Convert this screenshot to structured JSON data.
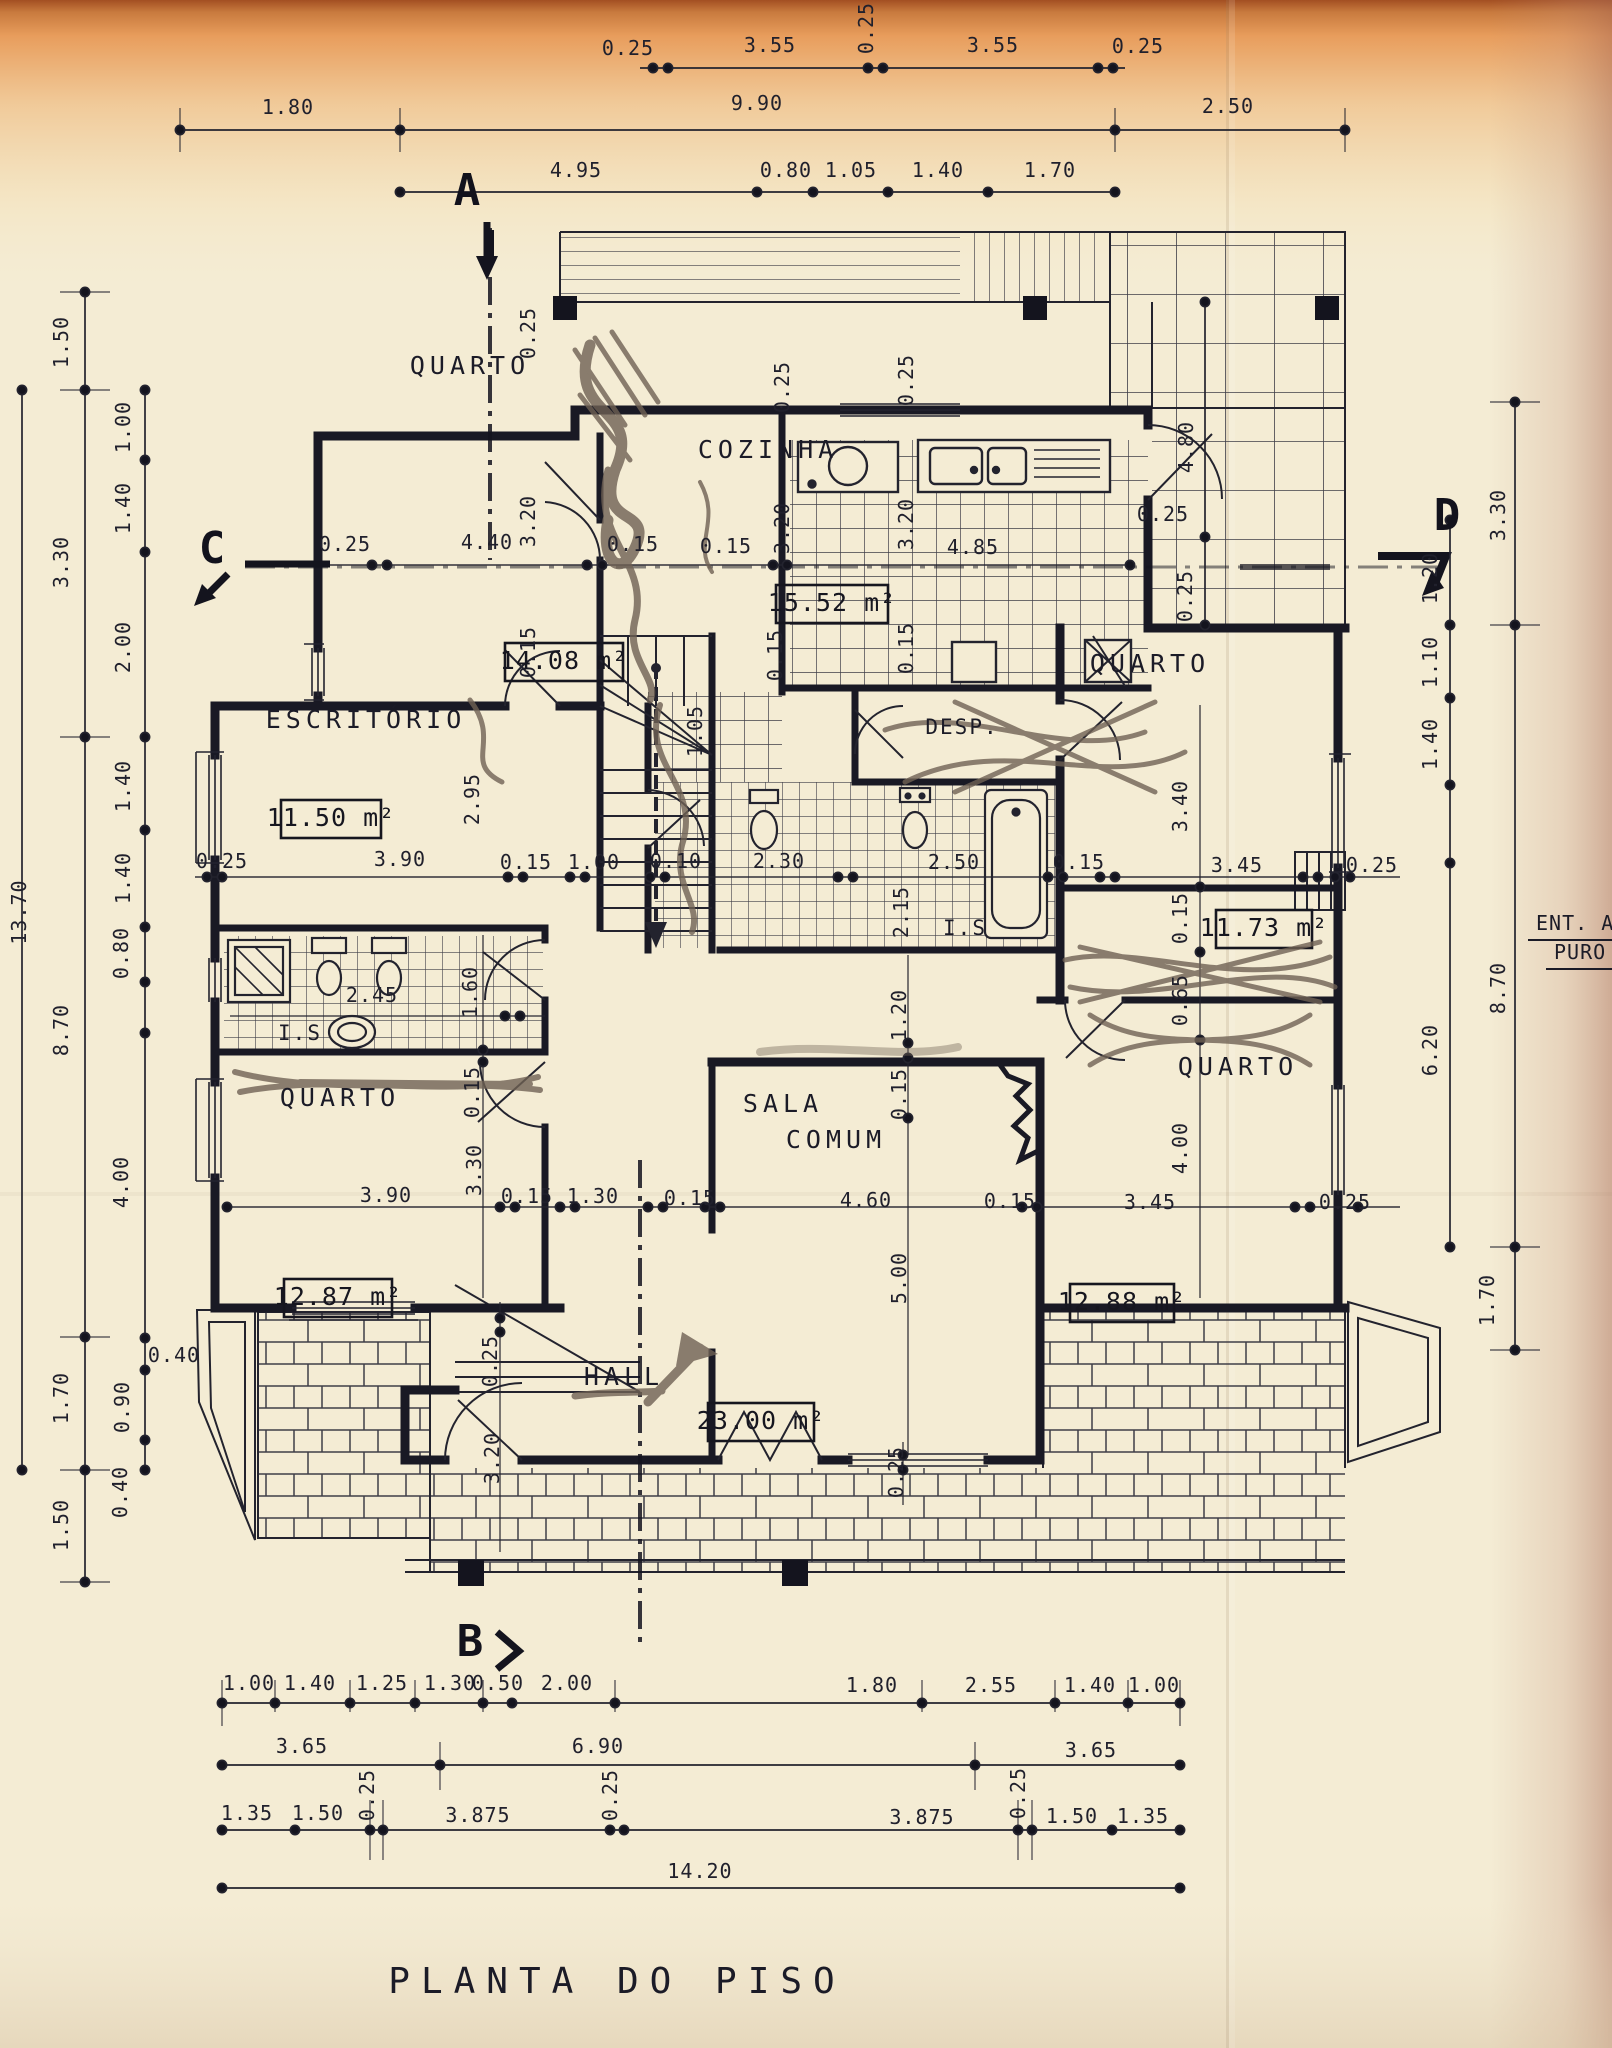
{
  "document": {
    "title": "PLANTA DO PISO",
    "type": "floor-plan-scan",
    "margin_note": [
      "ENT. A",
      "PURO"
    ],
    "overall_width_m": "14.20",
    "overall_height_m": "13.70"
  },
  "section_markers": [
    "A",
    "B",
    "C",
    "D"
  ],
  "rooms": [
    {
      "name": "QUARTO",
      "area": "14.08 m²",
      "dims": "4.40 x 3.20"
    },
    {
      "name": "COZINHA",
      "area": "15.52 m²",
      "dims": "4.85 x 3.20"
    },
    {
      "name": "ESCRITÓRIO",
      "area": "11.50 m²",
      "dims": "3.90 x 2.95"
    },
    {
      "name": "DESP.",
      "area": "",
      "dims": "1.05 high"
    },
    {
      "name": "QUARTO",
      "area": "11.73 m²",
      "dims": "3.45 x 3.40"
    },
    {
      "name": "QUARTO",
      "area": "12.87 m²",
      "dims": "3.90 x 3.30"
    },
    {
      "name": "SALA COMUM",
      "area": "23.00 m²",
      "dims": "4.60 x 5.00"
    },
    {
      "name": "QUARTO",
      "area": "12.88 m²",
      "dims": "3.45 x 4.00"
    },
    {
      "name": "HALL",
      "area": "",
      "dims": ""
    },
    {
      "name": "I.S.",
      "area": "",
      "dims": "2.45 x 1.60"
    },
    {
      "name": "I.S.",
      "area": "",
      "dims": "2.50 x 2.15"
    }
  ],
  "labels": [
    {
      "t": "0.25",
      "x": 628,
      "y": 55
    },
    {
      "t": "3.55",
      "x": 770,
      "y": 52
    },
    {
      "t": "0.25",
      "x": 873,
      "y": 28,
      "r": 1
    },
    {
      "t": "3.55",
      "x": 993,
      "y": 52
    },
    {
      "t": "0.25",
      "x": 1138,
      "y": 53
    },
    {
      "t": "1.80",
      "x": 288,
      "y": 114
    },
    {
      "t": "9.90",
      "x": 757,
      "y": 110
    },
    {
      "t": "2.50",
      "x": 1228,
      "y": 113
    },
    {
      "t": "4.95",
      "x": 576,
      "y": 177
    },
    {
      "t": "0.80",
      "x": 786,
      "y": 177
    },
    {
      "t": "1.05",
      "x": 851,
      "y": 177
    },
    {
      "t": "1.40",
      "x": 938,
      "y": 177
    },
    {
      "t": "1.70",
      "x": 1050,
      "y": 177
    },
    {
      "t": "1.50",
      "x": 68,
      "y": 342,
      "r": 1
    },
    {
      "t": "3.30",
      "x": 68,
      "y": 562,
      "r": 1
    },
    {
      "t": "8.70",
      "x": 68,
      "y": 1030,
      "r": 1
    },
    {
      "t": "1.70",
      "x": 68,
      "y": 1398,
      "r": 1
    },
    {
      "t": "1.50",
      "x": 68,
      "y": 1525,
      "r": 1
    },
    {
      "t": "13.70",
      "x": 26,
      "y": 912,
      "r": 1
    },
    {
      "t": "1.00",
      "x": 130,
      "y": 427,
      "r": 1
    },
    {
      "t": "1.40",
      "x": 130,
      "y": 508,
      "r": 1
    },
    {
      "t": "2.00",
      "x": 130,
      "y": 647,
      "r": 1
    },
    {
      "t": "1.40",
      "x": 130,
      "y": 786,
      "r": 1
    },
    {
      "t": "1.40",
      "x": 130,
      "y": 878,
      "r": 1
    },
    {
      "t": "0.80",
      "x": 128,
      "y": 953,
      "r": 1
    },
    {
      "t": "4.00",
      "x": 128,
      "y": 1182,
      "r": 1
    },
    {
      "t": "0.40",
      "x": 174,
      "y": 1362
    },
    {
      "t": "0.90",
      "x": 129,
      "y": 1407,
      "r": 1
    },
    {
      "t": "0.40",
      "x": 127,
      "y": 1492,
      "r": 1
    },
    {
      "t": "3.30",
      "x": 1505,
      "y": 515,
      "r": 1
    },
    {
      "t": "8.70",
      "x": 1505,
      "y": 988,
      "r": 1
    },
    {
      "t": "1.70",
      "x": 1494,
      "y": 1300,
      "r": 1
    },
    {
      "t": "1.20",
      "x": 1437,
      "y": 578,
      "r": 1
    },
    {
      "t": "1.10",
      "x": 1437,
      "y": 662,
      "r": 1
    },
    {
      "t": "1.40",
      "x": 1437,
      "y": 744,
      "r": 1
    },
    {
      "t": "6.20",
      "x": 1437,
      "y": 1050,
      "r": 1
    },
    {
      "t": "4.80",
      "x": 1193,
      "y": 447,
      "r": 1
    },
    {
      "t": "0.25",
      "x": 1163,
      "y": 521
    },
    {
      "t": "0.25",
      "x": 1192,
      "y": 596,
      "r": 1
    },
    {
      "t": "0.25",
      "x": 345,
      "y": 551
    },
    {
      "t": "4.40",
      "x": 487,
      "y": 549
    },
    {
      "t": "0.15",
      "x": 633,
      "y": 551
    },
    {
      "t": "0.15",
      "x": 726,
      "y": 553
    },
    {
      "t": "4.85",
      "x": 973,
      "y": 554
    },
    {
      "t": "0.25",
      "x": 535,
      "y": 333,
      "r": 1
    },
    {
      "t": "3.20",
      "x": 535,
      "y": 521,
      "r": 1
    },
    {
      "t": "0.15",
      "x": 535,
      "y": 652,
      "r": 1
    },
    {
      "t": "0.25",
      "x": 789,
      "y": 387,
      "r": 1
    },
    {
      "t": "3.20",
      "x": 789,
      "y": 528,
      "r": 1
    },
    {
      "t": "0.15",
      "x": 782,
      "y": 655,
      "r": 1
    },
    {
      "t": "0.25",
      "x": 913,
      "y": 380,
      "r": 1
    },
    {
      "t": "3.20",
      "x": 913,
      "y": 524,
      "r": 1
    },
    {
      "t": "0.15",
      "x": 913,
      "y": 648,
      "r": 1
    },
    {
      "t": "0.25",
      "x": 222,
      "y": 868
    },
    {
      "t": "3.90",
      "x": 400,
      "y": 866
    },
    {
      "t": "0.15",
      "x": 526,
      "y": 869
    },
    {
      "t": "1.00",
      "x": 594,
      "y": 869
    },
    {
      "t": "0.10",
      "x": 676,
      "y": 868
    },
    {
      "t": "2.30",
      "x": 779,
      "y": 868
    },
    {
      "t": "2.50",
      "x": 954,
      "y": 869
    },
    {
      "t": "0.15",
      "x": 1079,
      "y": 869
    },
    {
      "t": "3.45",
      "x": 1237,
      "y": 872
    },
    {
      "t": "0.25",
      "x": 1372,
      "y": 872
    },
    {
      "t": "2.95",
      "x": 479,
      "y": 799,
      "r": 1
    },
    {
      "t": "1.05",
      "x": 702,
      "y": 731,
      "r": 1
    },
    {
      "t": "3.40",
      "x": 1187,
      "y": 806,
      "r": 1
    },
    {
      "t": "2.15",
      "x": 908,
      "y": 912,
      "r": 1
    },
    {
      "t": "0.15",
      "x": 1187,
      "y": 918,
      "r": 1
    },
    {
      "t": "0.65",
      "x": 1187,
      "y": 1000,
      "r": 1
    },
    {
      "t": "4.00",
      "x": 1187,
      "y": 1148,
      "r": 1
    },
    {
      "t": "1.60",
      "x": 477,
      "y": 992,
      "r": 1
    },
    {
      "t": "2.45",
      "x": 372,
      "y": 1002
    },
    {
      "t": "0.15",
      "x": 479,
      "y": 1092,
      "r": 1
    },
    {
      "t": "3.30",
      "x": 481,
      "y": 1170,
      "r": 1
    },
    {
      "t": "1.20",
      "x": 906,
      "y": 1015,
      "r": 1
    },
    {
      "t": "0.15",
      "x": 906,
      "y": 1094,
      "r": 1
    },
    {
      "t": "5.00",
      "x": 906,
      "y": 1278,
      "r": 1
    },
    {
      "t": "3.90",
      "x": 386,
      "y": 1202
    },
    {
      "t": "0.15",
      "x": 527,
      "y": 1203
    },
    {
      "t": "1.30",
      "x": 593,
      "y": 1203
    },
    {
      "t": "0.15",
      "x": 690,
      "y": 1205
    },
    {
      "t": "4.60",
      "x": 866,
      "y": 1207
    },
    {
      "t": "0.15",
      "x": 1010,
      "y": 1208
    },
    {
      "t": "3.45",
      "x": 1150,
      "y": 1209
    },
    {
      "t": "0.25",
      "x": 1345,
      "y": 1209
    },
    {
      "t": "0.25",
      "x": 497,
      "y": 1361,
      "r": 1
    },
    {
      "t": "3.20",
      "x": 499,
      "y": 1458,
      "r": 1
    },
    {
      "t": "0.25",
      "x": 903,
      "y": 1472,
      "r": 1
    },
    {
      "t": "1.00",
      "x": 249,
      "y": 1690
    },
    {
      "t": "1.40",
      "x": 310,
      "y": 1690
    },
    {
      "t": "1.25",
      "x": 382,
      "y": 1690
    },
    {
      "t": "1.30",
      "x": 450,
      "y": 1690
    },
    {
      "t": "0.50",
      "x": 498,
      "y": 1690
    },
    {
      "t": "2.00",
      "x": 567,
      "y": 1690
    },
    {
      "t": "1.80",
      "x": 872,
      "y": 1692
    },
    {
      "t": "2.55",
      "x": 991,
      "y": 1692
    },
    {
      "t": "1.40",
      "x": 1090,
      "y": 1692
    },
    {
      "t": "1.00",
      "x": 1154,
      "y": 1692
    },
    {
      "t": "3.65",
      "x": 302,
      "y": 1753
    },
    {
      "t": "6.90",
      "x": 598,
      "y": 1753
    },
    {
      "t": "3.65",
      "x": 1091,
      "y": 1757
    },
    {
      "t": "1.35",
      "x": 247,
      "y": 1820
    },
    {
      "t": "1.50",
      "x": 318,
      "y": 1820
    },
    {
      "t": "0.25",
      "x": 374,
      "y": 1795,
      "r": 1
    },
    {
      "t": "3.875",
      "x": 478,
      "y": 1822
    },
    {
      "t": "0.25",
      "x": 617,
      "y": 1795,
      "r": 1
    },
    {
      "t": "3.875",
      "x": 922,
      "y": 1824
    },
    {
      "t": "0.25",
      "x": 1025,
      "y": 1793,
      "r": 1
    },
    {
      "t": "1.50",
      "x": 1072,
      "y": 1823
    },
    {
      "t": "1.35",
      "x": 1143,
      "y": 1823
    },
    {
      "t": "14.20",
      "x": 700,
      "y": 1878
    },
    {
      "t": "QUARTO",
      "x": 470,
      "y": 374,
      "c": "room"
    },
    {
      "t": "COZINHA",
      "x": 768,
      "y": 458,
      "c": "room"
    },
    {
      "t": "ESCRITÓRIO",
      "x": 366,
      "y": 728,
      "c": "room"
    },
    {
      "t": "DESP.",
      "x": 962,
      "y": 734,
      "c": "room2"
    },
    {
      "t": "QUARTO",
      "x": 1150,
      "y": 672,
      "c": "room"
    },
    {
      "t": "QUARTO",
      "x": 340,
      "y": 1106,
      "c": "room"
    },
    {
      "t": "SALA",
      "x": 783,
      "y": 1112,
      "c": "room"
    },
    {
      "t": "COMUM",
      "x": 836,
      "y": 1148,
      "c": "room"
    },
    {
      "t": "HALL",
      "x": 624,
      "y": 1385,
      "c": "room"
    },
    {
      "t": "QUARTO",
      "x": 1238,
      "y": 1075,
      "c": "room"
    },
    {
      "t": "I.S",
      "x": 300,
      "y": 1040,
      "c": "room2"
    },
    {
      "t": "I.S",
      "x": 965,
      "y": 935,
      "c": "room2"
    },
    {
      "t": "14.08 m²",
      "x": 564,
      "y": 669,
      "c": "area"
    },
    {
      "t": "15.52 m²",
      "x": 832,
      "y": 611,
      "c": "area"
    },
    {
      "t": "11.50 m²",
      "x": 331,
      "y": 826,
      "c": "area"
    },
    {
      "t": "11.73 m²",
      "x": 1264,
      "y": 936,
      "c": "area"
    },
    {
      "t": "12.87 m²",
      "x": 338,
      "y": 1305,
      "c": "area"
    },
    {
      "t": "12.88 m²",
      "x": 1122,
      "y": 1310,
      "c": "area"
    },
    {
      "t": "23.00 m²",
      "x": 761,
      "y": 1429,
      "c": "area"
    },
    {
      "t": "A",
      "x": 467,
      "y": 205,
      "c": "marker"
    },
    {
      "t": "B",
      "x": 470,
      "y": 1656,
      "c": "marker"
    },
    {
      "t": "C",
      "x": 212,
      "y": 563,
      "c": "marker"
    },
    {
      "t": "D",
      "x": 1447,
      "y": 530,
      "c": "marker"
    },
    {
      "t": "ENT. A",
      "x": 1536,
      "y": 930,
      "c": "note"
    },
    {
      "t": "PURO",
      "x": 1554,
      "y": 959,
      "c": "note"
    },
    {
      "t": "PLANTA  DO  PISO",
      "x": 617,
      "y": 1993,
      "c": "title"
    }
  ]
}
